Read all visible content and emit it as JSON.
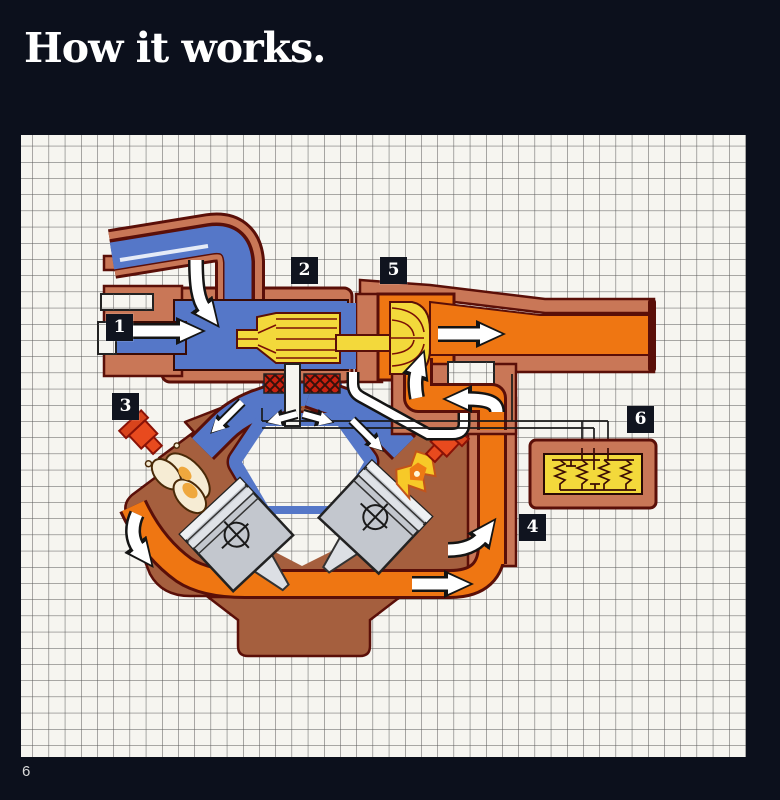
{
  "page": {
    "title": "How it works.",
    "page_number": "6"
  },
  "callouts": [
    {
      "num": "1"
    },
    {
      "num": "2"
    },
    {
      "num": "3"
    },
    {
      "num": "4"
    },
    {
      "num": "5"
    },
    {
      "num": "6"
    }
  ],
  "colors": {
    "page_bg": "#0c101c",
    "paper": "#f6f5f0",
    "grid_line": "#565656",
    "casing": "#c97757",
    "casing_dark": "#5a0f08",
    "intake_blue": "#5577c8",
    "exhaust_orange": "#ef7612",
    "turbo_yellow": "#f3d93b",
    "engine_brown": "#a55f3e",
    "piston_gray": "#c3c7ce",
    "plug_red": "#e84a1e",
    "flame_yellow": "#f7c928",
    "foam_cream": "#f6ecd4",
    "arrow_white": "#ffffff",
    "label_bg": "#10141f",
    "label_text": "#ffffff",
    "wire": "#1a1a1a"
  }
}
